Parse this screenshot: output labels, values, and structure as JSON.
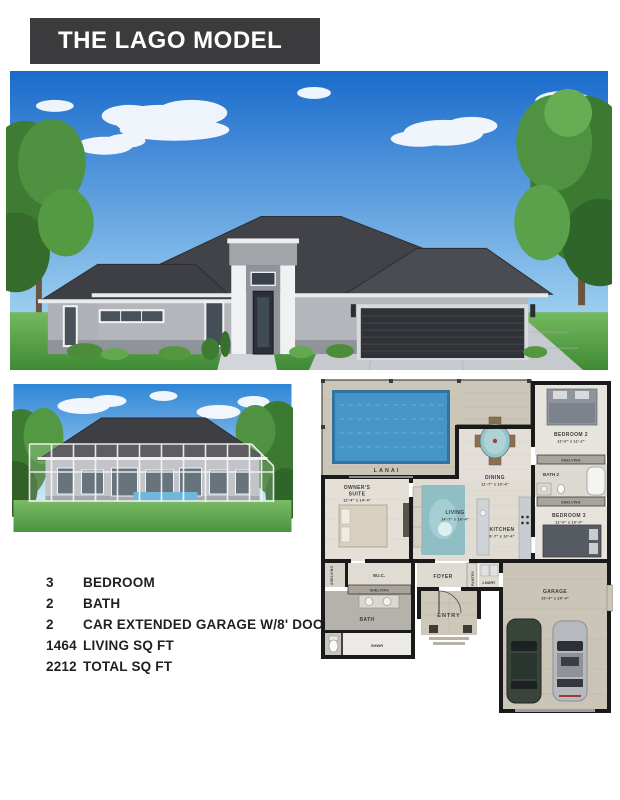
{
  "header": {
    "title": "THE LAGO MODEL"
  },
  "specs": {
    "items": [
      {
        "value": "3",
        "label": "BEDROOM"
      },
      {
        "value": "2",
        "label": "BATH"
      },
      {
        "value": "2",
        "label": "CAR EXTENDED GARAGE W/8' DOORS"
      },
      {
        "value": "1464",
        "label": "LIVING SQ FT"
      },
      {
        "value": "2212",
        "label": "TOTAL SQ FT"
      }
    ]
  },
  "floorplan": {
    "rooms": {
      "lanai": {
        "label": "LANAI"
      },
      "owners_suite": {
        "line1": "OWNER'S",
        "line2": "SUITE",
        "dims": "12'-4\" x 14'-4\""
      },
      "living": {
        "label": "LIVING",
        "dims": "14'-7\" x 16'-4\""
      },
      "dining": {
        "label": "DINING",
        "dims": "11'-7\" x 10'-4\""
      },
      "kitchen": {
        "label": "KITCHEN",
        "dims": "9'-7\" x 10'-4\""
      },
      "bedroom2": {
        "label": "BEDROOM 2",
        "dims": "12'-0\" x 11'-2\""
      },
      "bath2": {
        "label": "BATH 2"
      },
      "bedroom3": {
        "label": "BEDROOM 3",
        "dims": "12'-0\" x 10'-0\""
      },
      "garage": {
        "label": "GARAGE",
        "dims": "19'-4\" x 20'-4\""
      },
      "wic": {
        "label": "W.I.C."
      },
      "bath": {
        "label": "BATH"
      },
      "shwr": {
        "label": "SHWR"
      },
      "foyer": {
        "label": "FOYER"
      },
      "lndry": {
        "label": "LNDRY"
      },
      "pantry": {
        "label": "PANTRY"
      },
      "entry": {
        "label": "ENTRY"
      },
      "shelving": {
        "label": "SHELVING"
      }
    }
  },
  "colors": {
    "header_bg": "#3b3b3d",
    "sky_top": "#1a6bcc",
    "sky_bottom": "#9fd0f0",
    "roof": "#414348",
    "stucco": "#b4b6bc",
    "garage_door": "#303237",
    "lawn": "#5ea94c",
    "pool": "#4596c6",
    "paver": "#ccc6b9",
    "teal_accent": "#96c6ca",
    "wall": "#1a1a1a",
    "text": "#231f20"
  }
}
